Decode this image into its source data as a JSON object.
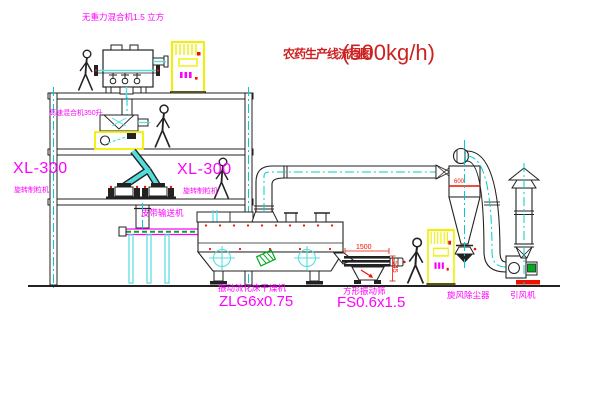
{
  "title": {
    "name": "农药生产线流程图",
    "capacity": "(500kg/h)"
  },
  "equipment_labels": {
    "zero_gravity_mixer": "无重力混合机1.5 立方",
    "high_speed_mixer": "高速混合机350升",
    "granulator_left": {
      "model": "XL-300",
      "name": "旋转制粒机"
    },
    "granulator_mid": {
      "model": "XL-300",
      "name": "旋转制粒机"
    },
    "belt_conveyor": "皮带输送机",
    "fluid_bed_dryer": {
      "name": "振动流化床干燥机",
      "model": "ZLG6x0.75"
    },
    "square_sieve": {
      "name": "方形振动筛",
      "model": "FS0.6x1.5"
    },
    "cyclone_dust_collector": "旋风除尘器",
    "induced_draft_fan": "引风机"
  },
  "dimensions": {
    "sieve_length": "1500",
    "sieve_height": "545",
    "cyclone_mark": "600"
  },
  "colors": {
    "background": "#ffffff",
    "label_magenta": "#ff00ff",
    "title_red": "#cc2222",
    "line_dark": "#222222",
    "centerline_cyan": "#00cccc",
    "pipe_cyan": "#55dddd",
    "highlight_yellow": "#f0f000",
    "hatch_green": "#00aa22",
    "accent_red": "#ee1100"
  }
}
